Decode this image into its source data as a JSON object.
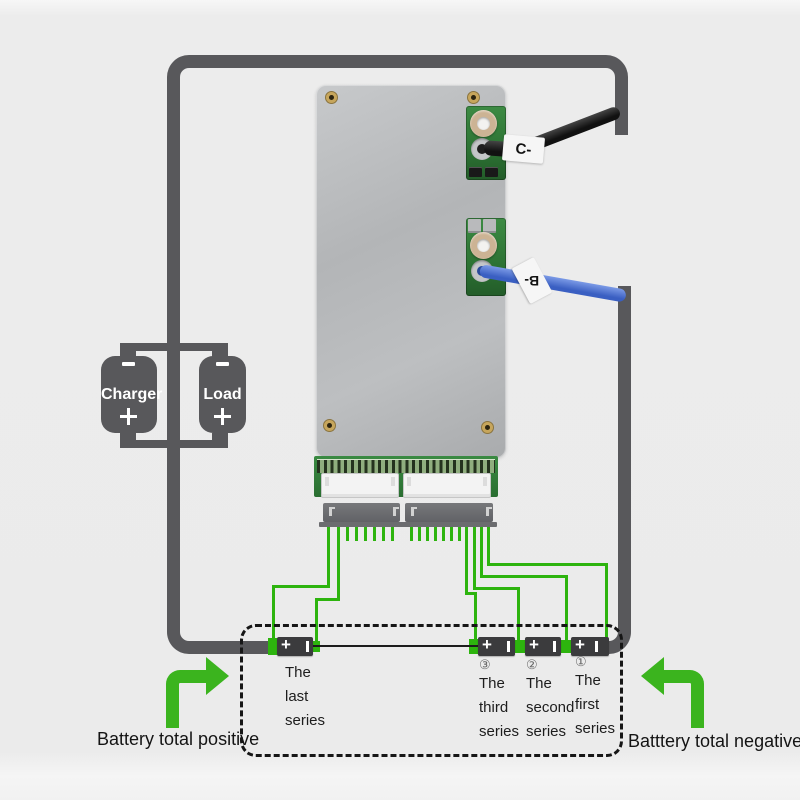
{
  "colors": {
    "background": "#ebebeb",
    "wire_gray": "#58585b",
    "sense_wire_green": "#2db40e",
    "arrow_green": "#3bb41e",
    "battery_body": "#3b3b3d",
    "pcb_green": "#2c7233",
    "blue_cable": "#3a5fc2",
    "black_cable": "#1a1a1a",
    "dash_outline": "#161616"
  },
  "charger_load": {
    "charger_label": "Charger",
    "load_label": "Load"
  },
  "board": {
    "c_wire_label": "C-",
    "b_wire_label": "B-"
  },
  "battery_bank": {
    "cells": [
      {
        "name": "last",
        "ordinal_mark": "",
        "plus": "+",
        "lines": [
          "The",
          "last",
          "series"
        ]
      },
      {
        "name": "third",
        "ordinal_mark": "③",
        "plus": "+",
        "lines": [
          "The",
          "third",
          "series"
        ]
      },
      {
        "name": "second",
        "ordinal_mark": "②",
        "plus": "+",
        "lines": [
          "The",
          "second",
          "series"
        ]
      },
      {
        "name": "first",
        "ordinal_mark": "①",
        "plus": "+",
        "lines": [
          "The",
          "first",
          "series"
        ]
      }
    ]
  },
  "annotations": {
    "positive_label": "Battery total positive",
    "negative_label": "Batttery total negative"
  }
}
